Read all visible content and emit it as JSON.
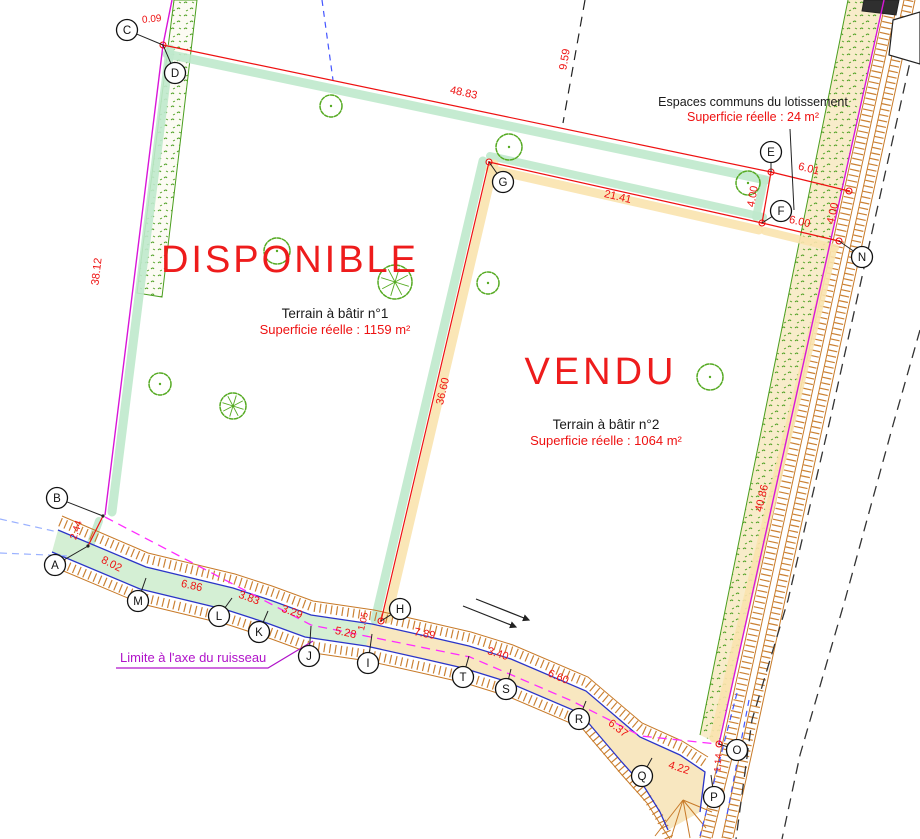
{
  "labels": {
    "plot1_status": "DISPONIBLE",
    "plot1_name": "Terrain à bâtir n°1",
    "plot1_area": "Superficie réelle : 1159 m²",
    "plot2_status": "VENDU",
    "plot2_name": "Terrain à bâtir n°2",
    "plot2_area": "Superficie réelle : 1064 m²",
    "common_title": "Espaces communs du lotissement",
    "common_area": "Superficie réelle : 24 m²",
    "stream_limit": "Limite à l'axe du ruisseau"
  },
  "colors": {
    "boundary_red": "#ee1111",
    "parcel_magenta": "#d816d8",
    "limit_dashed_magenta": "#ff2bff",
    "stream_blue": "#2b35c8",
    "talus_orange": "#c87a28",
    "vegetation_green": "#4a9e1e",
    "highlight_mint": "#bfe9cc",
    "highlight_tan": "#fae3ae",
    "label_purple": "#b013c9",
    "road_dash_black": "#333333"
  },
  "survey_points": [
    {
      "id": "C",
      "cx": 127,
      "cy": 30,
      "tx": 163,
      "ty": 45
    },
    {
      "id": "D",
      "cx": 175,
      "cy": 73,
      "tx": 163,
      "ty": 45
    },
    {
      "id": "E",
      "cx": 771,
      "cy": 152,
      "tx": 771,
      "ty": 172
    },
    {
      "id": "F",
      "cx": 781,
      "cy": 211,
      "tx": 762,
      "ty": 223
    },
    {
      "id": "G",
      "cx": 503,
      "cy": 182,
      "tx": 489,
      "ty": 162
    },
    {
      "id": "N",
      "cx": 862,
      "cy": 257,
      "tx": 839,
      "ty": 241
    },
    {
      "id": "B",
      "cx": 57,
      "cy": 498,
      "tx": 103,
      "ty": 516
    },
    {
      "id": "A",
      "cx": 55,
      "cy": 565,
      "tx": 88,
      "ty": 546
    },
    {
      "id": "M",
      "cx": 138,
      "cy": 601,
      "tx": 146,
      "ty": 578
    },
    {
      "id": "L",
      "cx": 219,
      "cy": 616,
      "tx": 232,
      "ty": 598
    },
    {
      "id": "K",
      "cx": 259,
      "cy": 632,
      "tx": 268,
      "ty": 611
    },
    {
      "id": "J",
      "cx": 309,
      "cy": 656,
      "tx": 311,
      "ty": 626
    },
    {
      "id": "I",
      "cx": 368,
      "cy": 663,
      "tx": 372,
      "ty": 634
    },
    {
      "id": "H",
      "cx": 400,
      "cy": 609,
      "tx": 381,
      "ty": 621
    },
    {
      "id": "T",
      "cx": 463,
      "cy": 677,
      "tx": 469,
      "ty": 656
    },
    {
      "id": "S",
      "cx": 506,
      "cy": 689,
      "tx": 511,
      "ty": 669
    },
    {
      "id": "R",
      "cx": 579,
      "cy": 719,
      "tx": 586,
      "ty": 701
    },
    {
      "id": "Q",
      "cx": 642,
      "cy": 776,
      "tx": 652,
      "ty": 758
    },
    {
      "id": "P",
      "cx": 714,
      "cy": 797,
      "tx": 711,
      "ty": 775
    },
    {
      "id": "O",
      "cx": 737,
      "cy": 750,
      "tx": 719,
      "ty": 744
    }
  ],
  "measurements": [
    {
      "value": "0.09",
      "x": 152,
      "y": 22,
      "rot": -5,
      "fs": 10
    },
    {
      "value": "48.83",
      "x": 463,
      "y": 96,
      "rot": 12
    },
    {
      "value": "9.59",
      "x": 568,
      "y": 60,
      "rot": -80
    },
    {
      "value": "6.01",
      "x": 808,
      "y": 172,
      "rot": 14
    },
    {
      "value": "4.00",
      "x": 756,
      "y": 197,
      "rot": -80
    },
    {
      "value": "6.00",
      "x": 799,
      "y": 225,
      "rot": 13
    },
    {
      "value": "4.00",
      "x": 836,
      "y": 214,
      "rot": -77
    },
    {
      "value": "21.41",
      "x": 617,
      "y": 200,
      "rot": 13
    },
    {
      "value": "36.60",
      "x": 446,
      "y": 392,
      "rot": -77
    },
    {
      "value": "38.12",
      "x": 100,
      "y": 272,
      "rot": -83
    },
    {
      "value": "2.44",
      "x": 79,
      "y": 531,
      "rot": -72,
      "fs": 10
    },
    {
      "value": "40.86",
      "x": 765,
      "y": 499,
      "rot": -77
    },
    {
      "value": "8.02",
      "x": 110,
      "y": 567,
      "rot": 27
    },
    {
      "value": "6.86",
      "x": 191,
      "y": 589,
      "rot": 13
    },
    {
      "value": "3.83",
      "x": 248,
      "y": 601,
      "rot": 20
    },
    {
      "value": "3.29",
      "x": 291,
      "y": 615,
      "rot": 19
    },
    {
      "value": "5.28",
      "x": 345,
      "y": 636,
      "rot": 12
    },
    {
      "value": "1.05",
      "x": 366,
      "y": 622,
      "rot": -77,
      "fs": 9.5
    },
    {
      "value": "7.89",
      "x": 424,
      "y": 637,
      "rot": 11
    },
    {
      "value": "3.40",
      "x": 497,
      "y": 657,
      "rot": 17
    },
    {
      "value": "6.60",
      "x": 557,
      "y": 680,
      "rot": 23
    },
    {
      "value": "6.37",
      "x": 616,
      "y": 731,
      "rot": 38
    },
    {
      "value": "4.22",
      "x": 678,
      "y": 771,
      "rot": 18
    },
    {
      "value": "1.14",
      "x": 721,
      "y": 763,
      "rot": -85,
      "fs": 9.5
    }
  ],
  "trees": [
    {
      "x": 331,
      "y": 106,
      "r": 11
    },
    {
      "x": 509,
      "y": 147,
      "r": 13
    },
    {
      "x": 748,
      "y": 183,
      "r": 12
    },
    {
      "x": 277,
      "y": 251,
      "r": 13
    },
    {
      "x": 395,
      "y": 282,
      "r": 17,
      "spokes": true
    },
    {
      "x": 488,
      "y": 283,
      "r": 11
    },
    {
      "x": 160,
      "y": 384,
      "r": 11
    },
    {
      "x": 233,
      "y": 406,
      "r": 13,
      "spokes": true
    },
    {
      "x": 710,
      "y": 377,
      "r": 13
    }
  ]
}
